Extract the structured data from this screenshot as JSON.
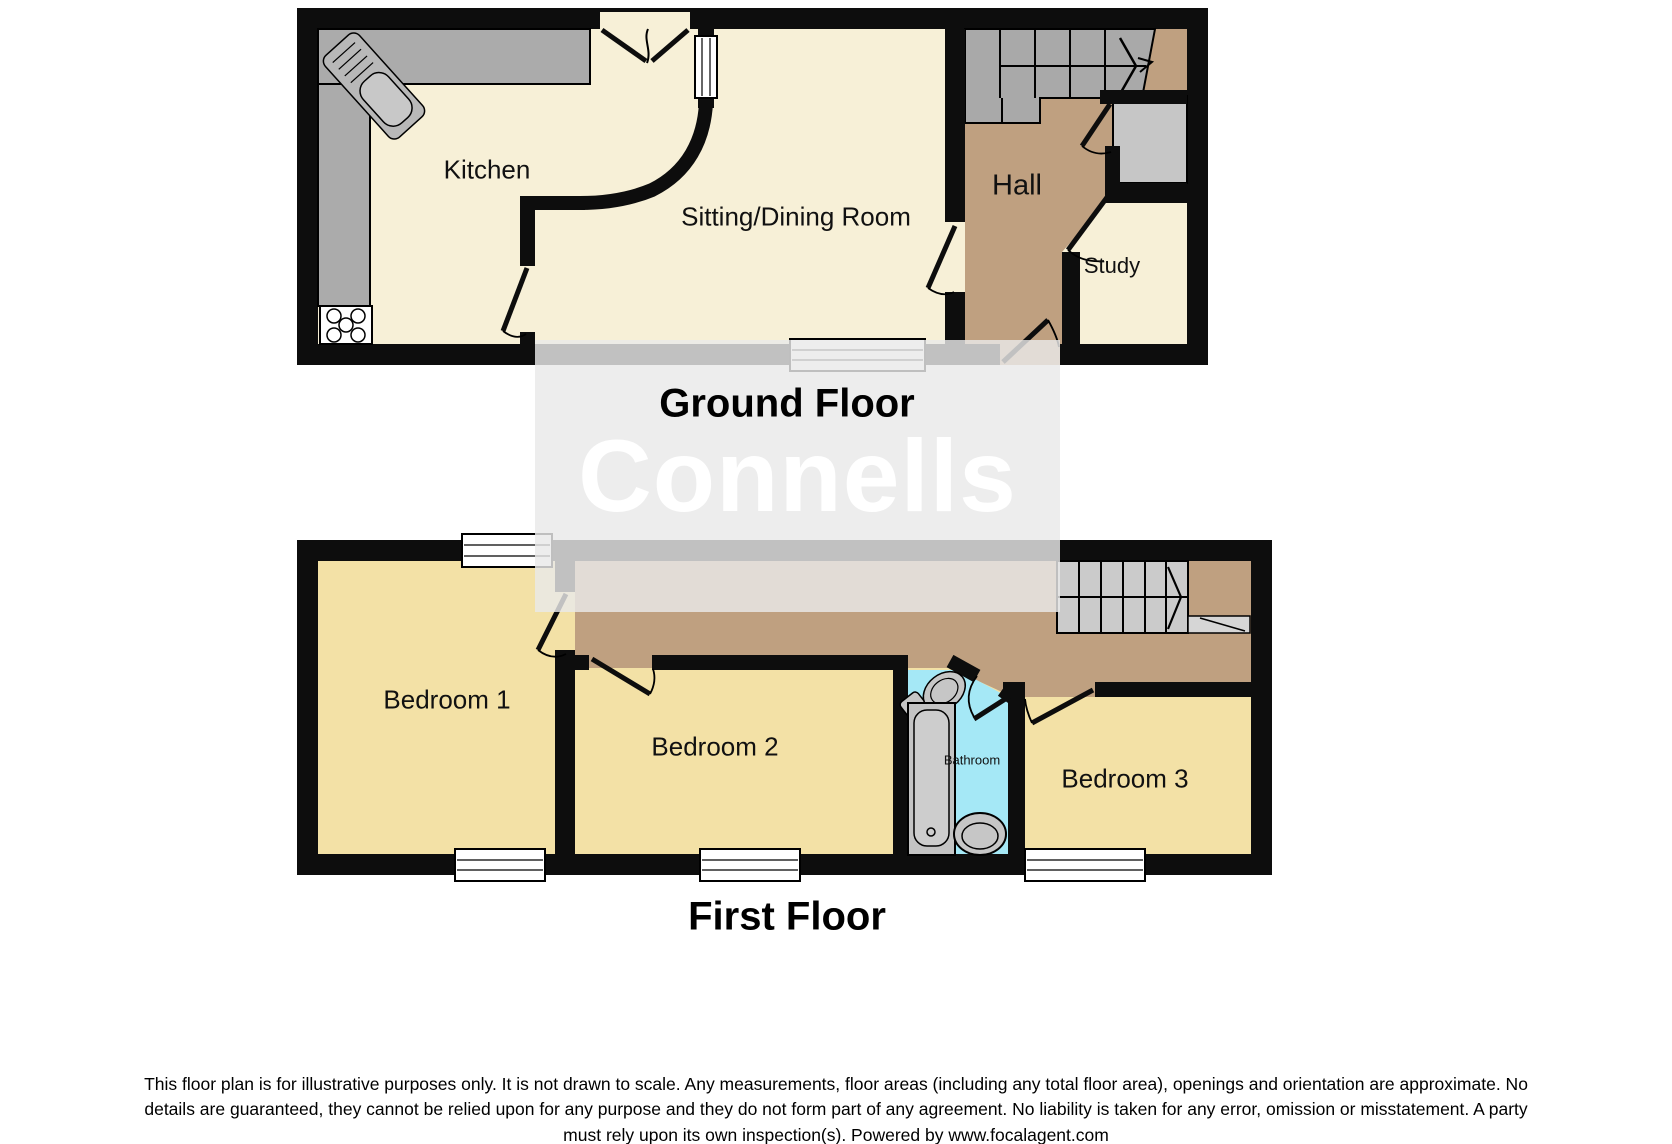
{
  "watermark": {
    "brand": "Connells"
  },
  "floors": [
    {
      "id": "ground",
      "title": "Ground Floor",
      "rooms": [
        {
          "name": "Kitchen"
        },
        {
          "name": "Sitting/Dining Room"
        },
        {
          "name": "Hall"
        },
        {
          "name": "Study"
        }
      ],
      "fixtures": [
        "kitchen-sink",
        "hob",
        "worktop-counter",
        "staircase-up-arrow",
        "cupboard",
        "entrance-door",
        "french-doors",
        "window"
      ]
    },
    {
      "id": "first",
      "title": "First Floor",
      "rooms": [
        {
          "name": "Bedroom 1"
        },
        {
          "name": "Bedroom 2"
        },
        {
          "name": "Bathroom"
        },
        {
          "name": "Bedroom 3"
        }
      ],
      "fixtures": [
        "staircase-arrow",
        "stair-railing",
        "toilet",
        "bath",
        "basin",
        "windows"
      ]
    }
  ],
  "disclaimer": {
    "lines": [
      "This floor plan is for illustrative purposes only. It is not drawn to scale. Any measurements, floor areas (including any total floor area), openings and orientation are approximate. No",
      "details are guaranteed, they cannot be relied upon for any purpose and they do not form part of any agreement. No liability is taken for any error, omission or misstatement. A party",
      "must rely upon its own inspection(s). Powered by www.focalagent.com"
    ]
  },
  "colors": {
    "wall": "#0d0d0d",
    "room_cream": "#f7f0d7",
    "bedroom_yellow": "#f3e1a6",
    "hall_tan": "#bfa080",
    "bathroom_blue": "#a5e8f6",
    "stairs_gray_ground": "#a9a9a9",
    "stairs_gray_first": "#cbcbcb",
    "counter_gray": "#ababab",
    "cupboard_gray": "#c6c6c6",
    "watermark_box": "#e9e9e9",
    "watermark_text": "#ffffff"
  }
}
